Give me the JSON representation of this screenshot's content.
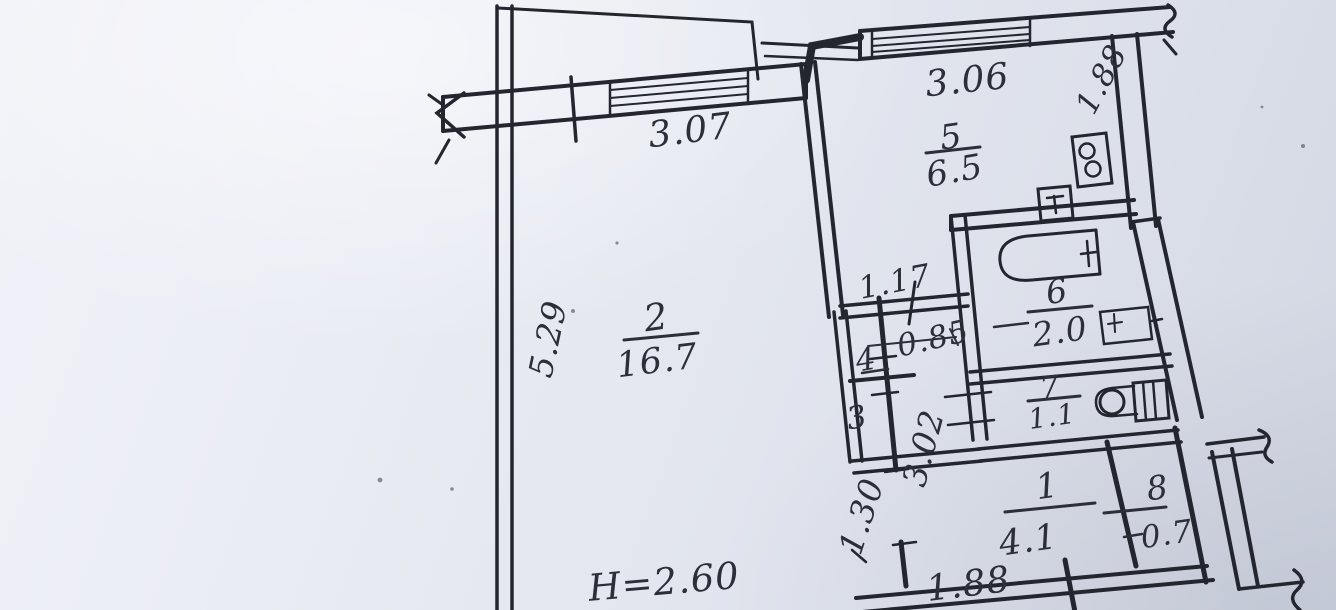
{
  "plan": {
    "height_note": "H=2.60",
    "rooms": [
      {
        "number": "2",
        "area": "16.7"
      },
      {
        "number": "5",
        "area": "6.5"
      },
      {
        "number": "6",
        "area": "2.0"
      },
      {
        "number": "7",
        "area": "1.1"
      },
      {
        "number": "1",
        "area": "4.1"
      },
      {
        "number": "8",
        "area": "0.7"
      }
    ],
    "closets": [
      {
        "number": "4"
      },
      {
        "number": "3"
      }
    ],
    "dimensions": {
      "living_top": "3.07",
      "kitchen_top": "3.06",
      "kitchen_side": "1.88",
      "living_side": "5.29",
      "closet_top": "1.17",
      "passage": "0.85",
      "corridor": "3.02",
      "hall_door": "1.30",
      "entry_bottom": "1.88"
    },
    "fixtures": {
      "bathtub": "bathtub-icon",
      "toilet": "toilet-icon",
      "bathroom_sink": "washbasin-icon",
      "kitchen_sink": "kitchen-sink-icon",
      "stove": "stove-icon"
    },
    "colors": {
      "paper": "#e8eaf2",
      "ink": "#24262f"
    }
  }
}
